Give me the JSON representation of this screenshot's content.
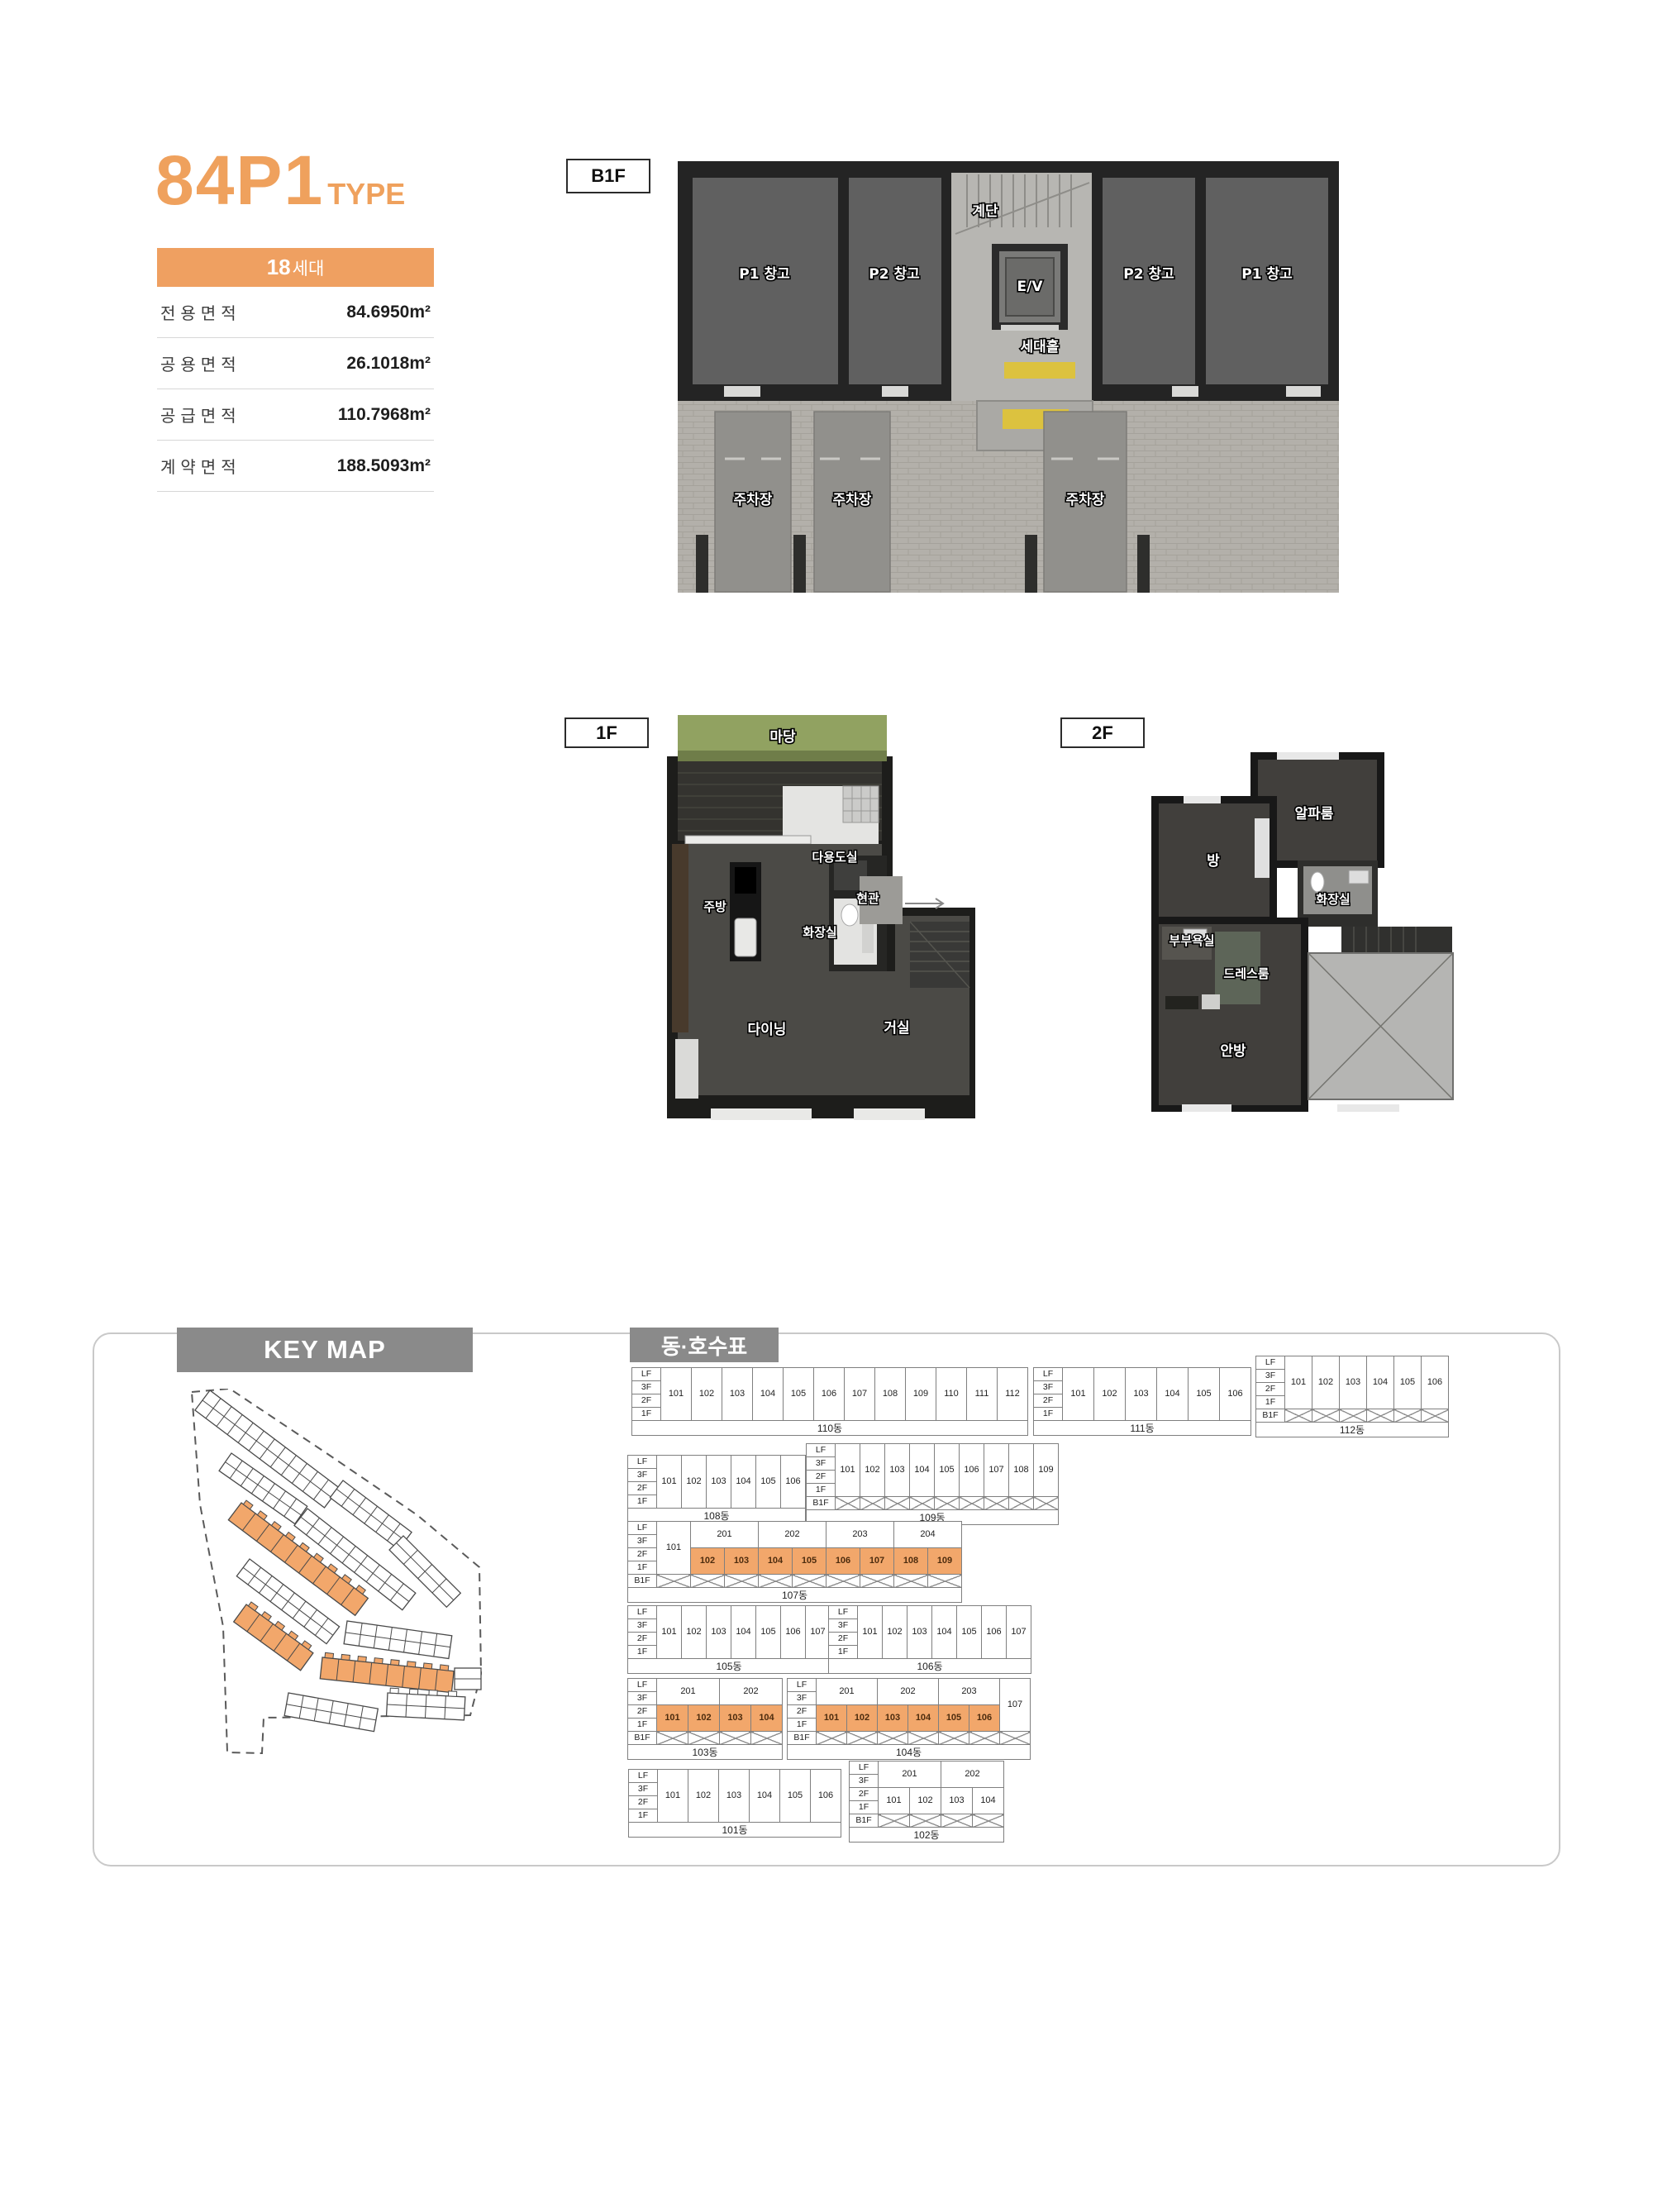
{
  "page": {
    "title": "84P1",
    "title_suffix": "TYPE",
    "badge_num": "18",
    "badge_unit": "세대",
    "area_table": [
      {
        "label": "전용면적",
        "value": "84.6950m²"
      },
      {
        "label": "공용면적",
        "value": "26.1018m²"
      },
      {
        "label": "공급면적",
        "value": "110.7968m²"
      },
      {
        "label": "계약면적",
        "value": "188.5093m²"
      }
    ]
  },
  "colors": {
    "accent_orange": "#EFA15D",
    "cell_orange": "#F2A76B",
    "header_gray": "#8A8A8A",
    "yard_green": "#91A261",
    "mat_yellow": "#DCC23F"
  },
  "plans": {
    "b1f": {
      "label": "B1F",
      "rooms": {
        "stairs": "계단",
        "p1_left": "P1 창고",
        "p2_left": "P2 창고",
        "ev": "E/V",
        "hall": "세대홀",
        "p2_right": "P2 창고",
        "p1_right": "P1 창고",
        "parking1": "주차장",
        "parking2": "주차장",
        "parking3": "주차장"
      }
    },
    "f1": {
      "label": "1F",
      "rooms": {
        "yard": "마당",
        "utility": "다용도실",
        "kitchen": "주방",
        "entrance": "현관",
        "bath": "화장실",
        "dining": "다이닝",
        "living": "거실"
      }
    },
    "f2": {
      "label": "2F",
      "rooms": {
        "alpha": "알파룸",
        "room": "방",
        "bath": "화장실",
        "couple_bath": "부부욕실",
        "dress": "드레스룸",
        "master": "안방"
      }
    }
  },
  "key_map": {
    "header": "KEY MAP"
  },
  "units": {
    "header": "동·호수표",
    "buildings": {
      "b110": {
        "name": "110동",
        "floors": [
          "LF",
          "3F",
          "2F",
          "1F"
        ],
        "units": [
          "101",
          "102",
          "103",
          "104",
          "105",
          "106",
          "107",
          "108",
          "109",
          "110",
          "111",
          "112"
        ]
      },
      "b111": {
        "name": "111동",
        "floors": [
          "LF",
          "3F",
          "2F",
          "1F"
        ],
        "units": [
          "101",
          "102",
          "103",
          "104",
          "105",
          "106"
        ]
      },
      "b112": {
        "name": "112동",
        "floors": [
          "LF",
          "3F",
          "2F",
          "1F",
          "B1F"
        ],
        "units": [
          "101",
          "102",
          "103",
          "104",
          "105",
          "106"
        ]
      },
      "b108": {
        "name": "108동",
        "floors": [
          "LF",
          "3F",
          "2F",
          "1F"
        ],
        "units": [
          "101",
          "102",
          "103",
          "104",
          "105",
          "106"
        ]
      },
      "b109": {
        "name": "109동",
        "floors": [
          "LF",
          "3F",
          "2F",
          "1F",
          "B1F"
        ],
        "units": [
          "101",
          "102",
          "103",
          "104",
          "105",
          "106",
          "107",
          "108",
          "109"
        ]
      },
      "b107": {
        "name": "107동",
        "floors": [
          "LF",
          "3F",
          "2F",
          "1F",
          "B1F"
        ],
        "left_col": "101",
        "top_units": [
          "201",
          "202",
          "203",
          "204"
        ],
        "bottom_units": [
          "102",
          "103",
          "104",
          "105",
          "106",
          "107",
          "108",
          "109"
        ],
        "orange": true
      },
      "b105": {
        "name": "105동",
        "floors": [
          "LF",
          "3F",
          "2F",
          "1F"
        ],
        "units": [
          "101",
          "102",
          "103",
          "104",
          "105",
          "106",
          "107"
        ]
      },
      "b106": {
        "name": "106동",
        "floors": [
          "LF",
          "3F",
          "2F",
          "1F"
        ],
        "units": [
          "101",
          "102",
          "103",
          "104",
          "105",
          "106",
          "107"
        ]
      },
      "b103": {
        "name": "103동",
        "floors": [
          "LF",
          "3F",
          "2F",
          "1F",
          "B1F"
        ],
        "top_units": [
          "201",
          "202"
        ],
        "bottom_units": [
          "101",
          "102",
          "103",
          "104"
        ],
        "orange": true
      },
      "b104": {
        "name": "104동",
        "floors": [
          "LF",
          "3F",
          "2F",
          "1F",
          "B1F"
        ],
        "top_units": [
          "201",
          "202",
          "203"
        ],
        "right_col": "107",
        "bottom_units": [
          "101",
          "102",
          "103",
          "104",
          "105",
          "106"
        ],
        "orange": true
      },
      "b101": {
        "name": "101동",
        "floors": [
          "LF",
          "3F",
          "2F",
          "1F"
        ],
        "units": [
          "101",
          "102",
          "103",
          "104",
          "105",
          "106"
        ]
      },
      "b102": {
        "name": "102동",
        "floors": [
          "LF",
          "3F",
          "2F",
          "1F",
          "B1F"
        ],
        "top_units": [
          "201",
          "202"
        ],
        "bottom_units": [
          "101",
          "102",
          "103",
          "104"
        ],
        "orange": false
      }
    }
  }
}
